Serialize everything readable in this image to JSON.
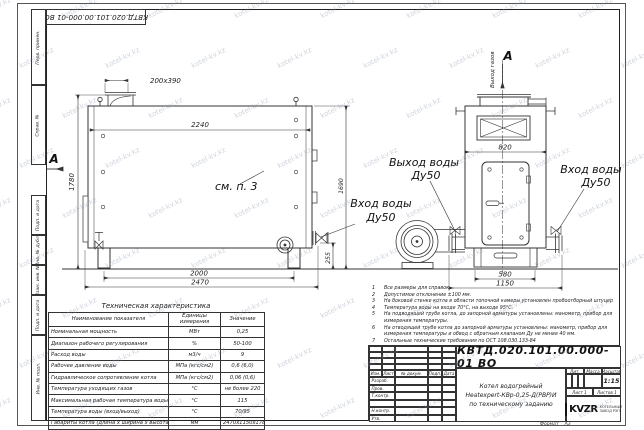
{
  "watermark": {
    "text": "kotel-kv.kz"
  },
  "frame": {
    "top_stamp": "КВТД.020.101.00.000-01 ВО",
    "side_stamps": [
      "Перв. примен.",
      "Справ. №",
      "Подп. и дата",
      "Инв. № дубл.",
      "Взам. инв. №",
      "Подп. и дата",
      "Инв. № подл."
    ]
  },
  "drawing": {
    "labels": {
      "section": "А",
      "see_note": "см. п. 3",
      "water_outlet": "Выход воды",
      "water_inlet": "Вход воды",
      "dn": "Ду50",
      "gas_outlet": "Выход газов"
    },
    "dims": {
      "chimney_cutout": "200х390",
      "boiler_length": "2240",
      "boiler_height": "1780",
      "support_span": "2000",
      "overall_length": "2470",
      "pipe_axis_height": "255",
      "body_height": "1690",
      "top_width": "820",
      "base_width": "580",
      "overall_width": "1150"
    }
  },
  "notes": {
    "items": [
      "Все размеры для справок",
      "Допустимое отклонение ±100 мм.",
      "На боковой стенке котла в области топочной камеры установлен пробоотборный штуцер",
      "Температура воды на входе 70°С, на выходе 95°С.",
      "На подводящей трубе котла, до запорной арматуры установлены: манометр, прибор для измерения температуры.",
      "На отводящей трубе котла до запорной арматуры установлены: манометр, прибор для измерения температуры и обвод с обратным клапаном Ду не менее 40 мм.",
      "Остальные технические требования по ОСТ 108.030.133-84"
    ]
  },
  "tech_table": {
    "title": "Техническая характеристика",
    "headers": [
      "Наименование показателя",
      "Единицы измерения",
      "Значение"
    ],
    "rows": [
      [
        "Номинальная мощность",
        "МВт",
        "0,25"
      ],
      [
        "Диапазон рабочего регулирования",
        "%",
        "50-100"
      ],
      [
        "Расход воды",
        "м3/ч",
        "9"
      ],
      [
        "Рабочее давление воды",
        "МПа (кгс/см2)",
        "0,6 (6,0)"
      ],
      [
        "Гидравлическое сопротивление котла",
        "МПа (кгс/см2)",
        "0,06 (0,6)"
      ],
      [
        "Температура уходящих газов",
        "°С",
        "не более 220"
      ],
      [
        "Максимальная рабочая температура воды",
        "°С",
        "115"
      ],
      [
        "Температура воды (вход/выход)",
        "°С",
        "70/95"
      ],
      [
        "Габариты котла (длина х ширина х высота)",
        "мм",
        "2470х1150х1780"
      ]
    ]
  },
  "title_block": {
    "doc_number": "КВТД.020.101.00.000-01 ВО",
    "name_line1": "Котел водогрейный",
    "name_line2": "Heatexpert-КВр-0,25-Д(РВР)И",
    "name_line3": "по техническому заданию",
    "sig_headers": [
      "Изм.",
      "Лист",
      "№ докум.",
      "Подп.",
      "Дата"
    ],
    "sig_rows": [
      "Разраб.",
      "Пров.",
      "Т.контр.",
      "Н.контр.",
      "Утв."
    ],
    "lit_label": "Лит.",
    "mass_label": "Масса",
    "scale_label": "Масштаб",
    "scale_value": "1:15",
    "sheet_label": "Лист",
    "sheet_value": "1",
    "sheets_label": "Листов",
    "sheets_value": "1",
    "logo_text": "KVZR",
    "logo_sub1": "КОТЕЛЬНЫЙ",
    "logo_sub2": "ЗАВОД РЭП",
    "format_label": "Формат",
    "format_value": "А3"
  }
}
